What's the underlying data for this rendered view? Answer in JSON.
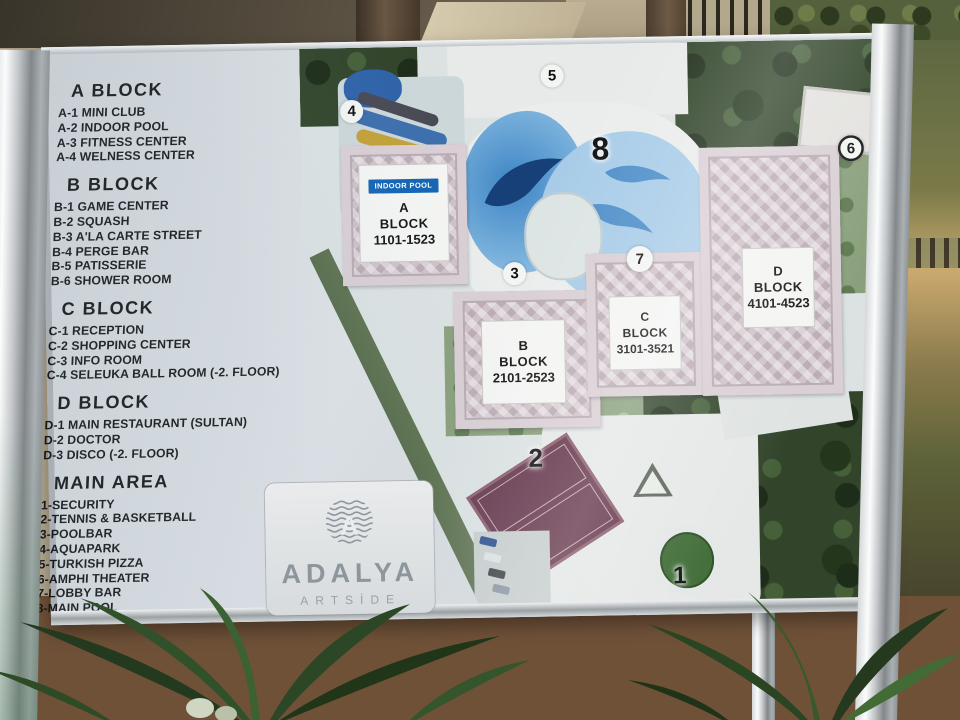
{
  "sign": {
    "legend": {
      "sections": [
        {
          "heading": "A BLOCK",
          "items": [
            "A-1 MINI CLUB",
            "A-2 INDOOR POOL",
            "A-3 FITNESS CENTER",
            "A-4 WELNESS CENTER"
          ]
        },
        {
          "heading": "B BLOCK",
          "items": [
            "B-1 GAME CENTER",
            "B-2 SQUASH",
            "B-3 A'LA CARTE STREET",
            "B-4 PERGE BAR",
            "B-5 PATISSERIE",
            "B-6 SHOWER ROOM"
          ]
        },
        {
          "heading": "C BLOCK",
          "items": [
            "C-1 RECEPTION",
            "C-2 SHOPPING CENTER",
            "C-3 INFO ROOM",
            "C-4 SELEUKA BALL ROOM (-2. FLOOR)"
          ]
        },
        {
          "heading": "D BLOCK",
          "items": [
            "D-1 MAIN RESTAURANT (SULTAN)",
            "D-2 DOCTOR",
            "D-3 DISCO (-2. FLOOR)"
          ]
        },
        {
          "heading": "MAIN AREA",
          "items": [
            "1-SECURITY",
            "2-TENNIS & BASKETBALL",
            "3-POOLBAR",
            "4-AQUAPARK",
            "5-TURKISH PIZZA",
            "6-AMPHI THEATER",
            "7-LOBBY BAR",
            "8-MAIN POOL"
          ]
        }
      ]
    },
    "map": {
      "blocks": [
        {
          "letter": "A",
          "word": "BLOCK",
          "rooms": "1101-1523",
          "badge": "INDOOR POOL"
        },
        {
          "letter": "B",
          "word": "BLOCK",
          "rooms": "2101-2523"
        },
        {
          "letter": "C",
          "word": "BLOCK",
          "rooms": "3101-3521"
        },
        {
          "letter": "D",
          "word": "BLOCK",
          "rooms": "4101-4523"
        }
      ],
      "markers": [
        "1",
        "2",
        "3",
        "4",
        "5",
        "6",
        "7",
        "8"
      ]
    },
    "logo": {
      "brand": "ADALYA",
      "sub": "ARTSİDE",
      "emblem_letter": "A"
    }
  },
  "colors": {
    "badge_blue": "#1565b4",
    "pool_blue": "#57a0d8",
    "pool_dark": "#173f78",
    "sign_gray": "#ced4d8",
    "tree_green": "#32452b",
    "tennis_maroon": "#63354a",
    "navy_trees": "#24466b",
    "building_pink": "#cfc2c8"
  }
}
